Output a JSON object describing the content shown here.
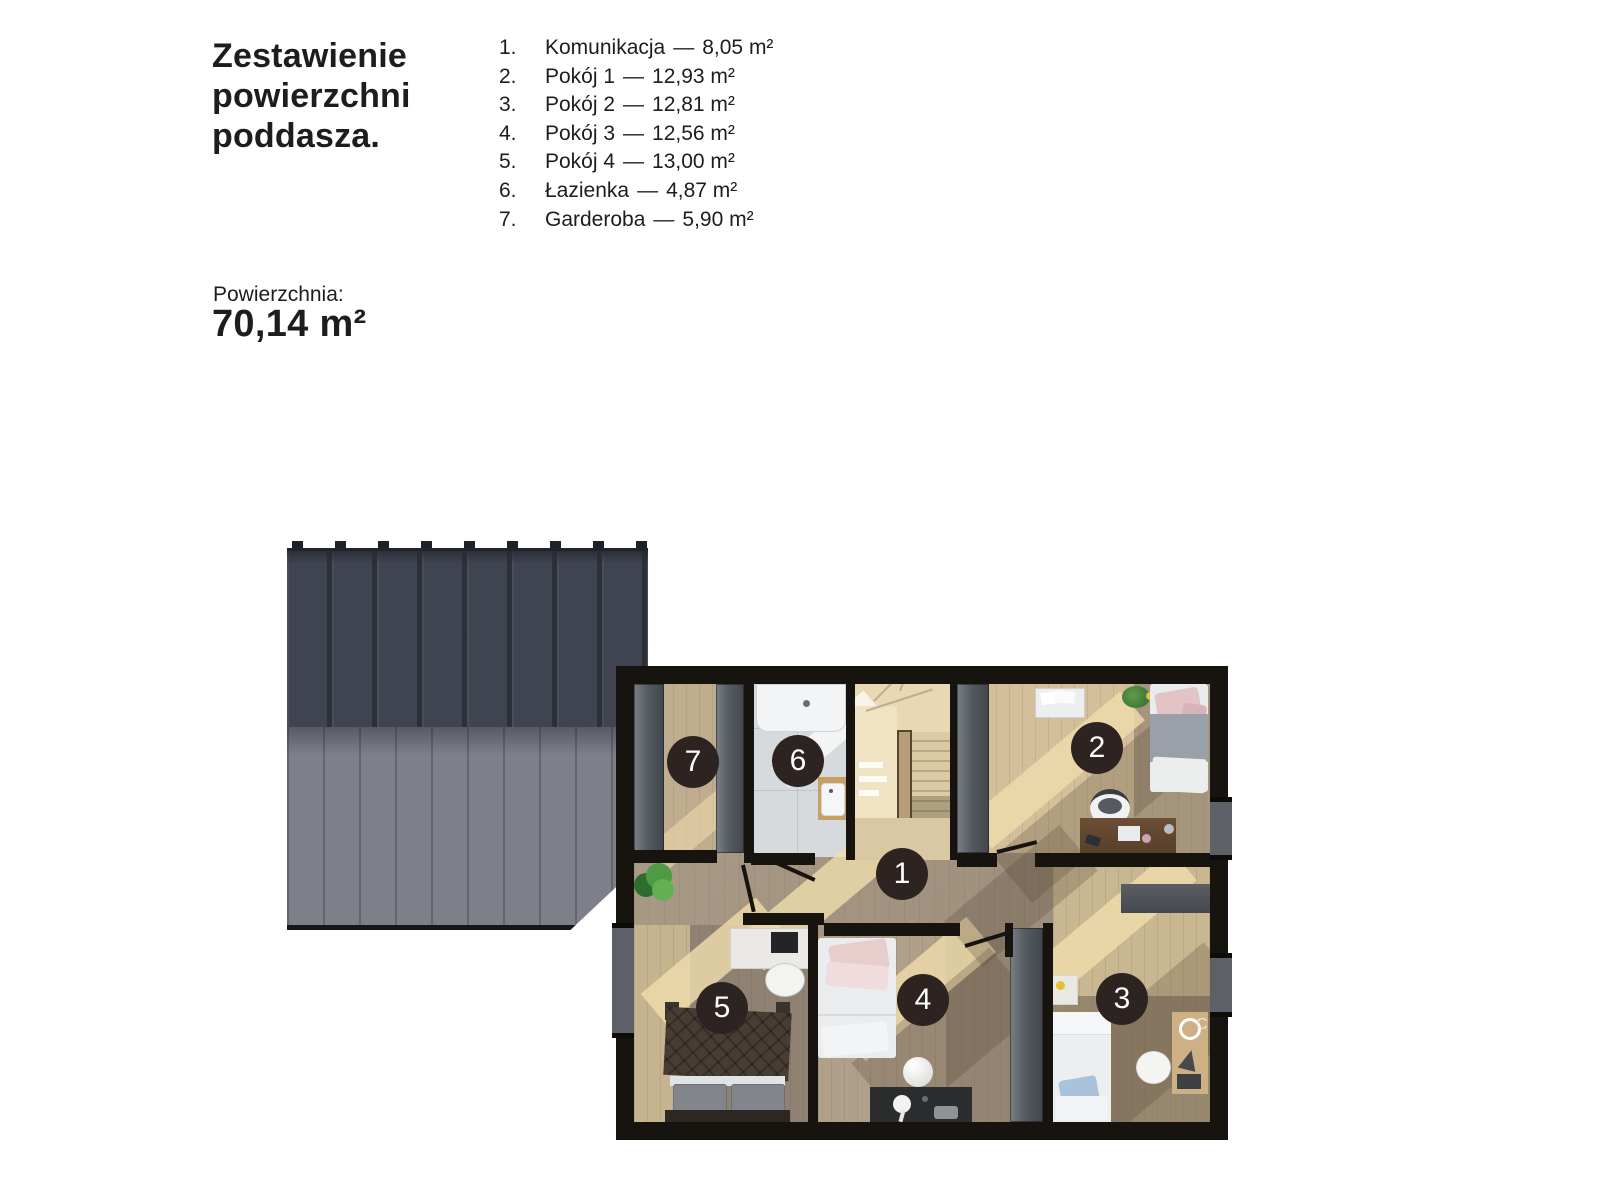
{
  "header": {
    "title_lines": [
      "Zestawienie",
      "powierzchni",
      "poddasza."
    ],
    "area_label": "Powierzchnia:",
    "area_value": "70,14 m²"
  },
  "legend": {
    "dash": "—",
    "items": [
      {
        "num": "1.",
        "name": "Komunikacja",
        "area": "8,05 m²"
      },
      {
        "num": "2.",
        "name": "Pokój 1",
        "area": "12,93 m²"
      },
      {
        "num": "3.",
        "name": "Pokój 2",
        "area": "12,81 m²"
      },
      {
        "num": "4.",
        "name": "Pokój 3",
        "area": "12,56 m²"
      },
      {
        "num": "5.",
        "name": "Pokój 4",
        "area": "13,00 m²"
      },
      {
        "num": "6.",
        "name": "Łazienka",
        "area": "4,87 m²"
      },
      {
        "num": "7.",
        "name": "Garderoba",
        "area": "5,90 m²"
      }
    ]
  },
  "plan": {
    "markers": [
      {
        "label": "1"
      },
      {
        "label": "2"
      },
      {
        "label": "3"
      },
      {
        "label": "4"
      },
      {
        "label": "5"
      },
      {
        "label": "6"
      },
      {
        "label": "7"
      }
    ],
    "decor_letter": "C",
    "colors": {
      "wall": "#17130f",
      "marker_bg": "#2d2422",
      "marker_text": "#ffffff",
      "roof_dark": "#3f4450",
      "roof_light": "#7d8089",
      "floor_light_wood": "#d3bf99",
      "floor_shadow_wood": "#9c8e7e",
      "bath_tile": "#d7dadc",
      "sunlight": "#f0ddac"
    }
  }
}
